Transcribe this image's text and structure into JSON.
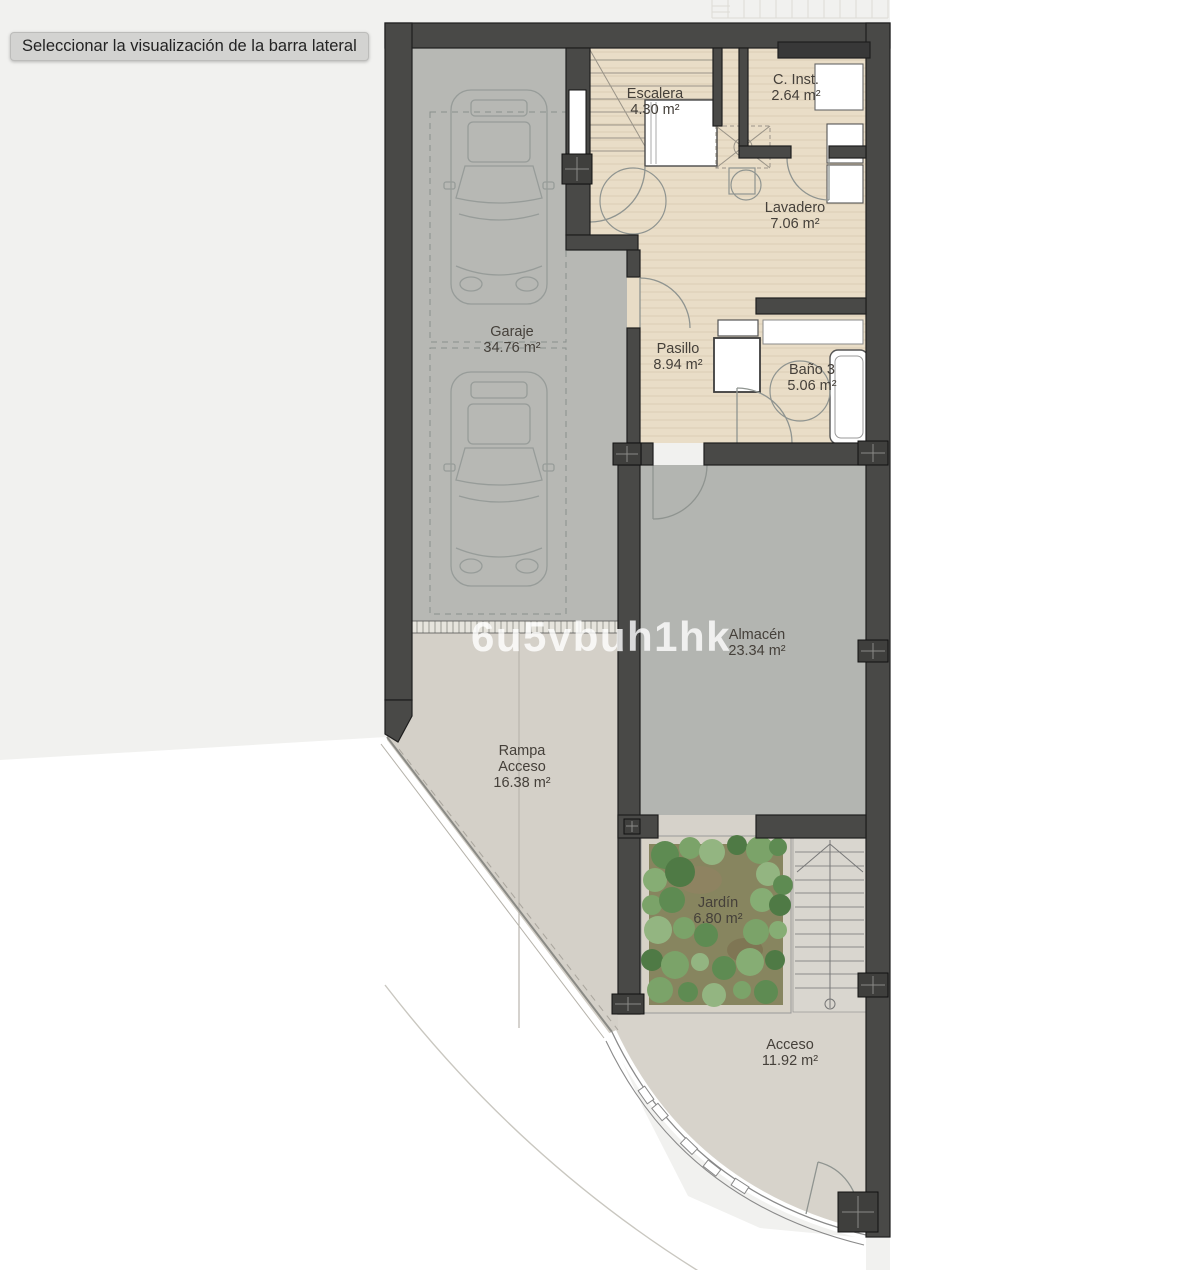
{
  "tooltip": {
    "text": "Seleccionar la visualización de la barra lateral"
  },
  "watermark": {
    "text": "6u5vbuh1hk"
  },
  "plan": {
    "rooms": {
      "escalera": {
        "name": "Escalera",
        "area": "4.30 m²"
      },
      "c_inst": {
        "name": "C. Inst.",
        "area": "2.64 m²"
      },
      "lavadero": {
        "name": "Lavadero",
        "area": "7.06 m²"
      },
      "garaje": {
        "name": "Garaje",
        "area": "34.76 m²"
      },
      "pasillo": {
        "name": "Pasillo",
        "area": "8.94 m²"
      },
      "bano3": {
        "name": "Baño 3",
        "area": "5.06 m²"
      },
      "almacen": {
        "name": "Almacén",
        "area": "23.34 m²"
      },
      "rampa": {
        "line1": "Rampa",
        "line2": "Acceso",
        "area": "16.38 m²"
      },
      "jardin": {
        "name": "Jardín",
        "area": "6.80 m²"
      },
      "acceso": {
        "name": "Acceso",
        "area": "11.92 m²"
      }
    }
  },
  "colors": {
    "wall": "#494947",
    "floor_tan": "#e9ddc7",
    "floor_garage": "#b7b8b4",
    "floor_storage": "#b3b5b1",
    "floor_concrete": "#d6d2ca",
    "garden_green": "#6f9a5e",
    "watermark": "rgba(255,255,255,0.8)",
    "tooltip_bg": "#d3d3d1",
    "label_text": "#45403a"
  }
}
